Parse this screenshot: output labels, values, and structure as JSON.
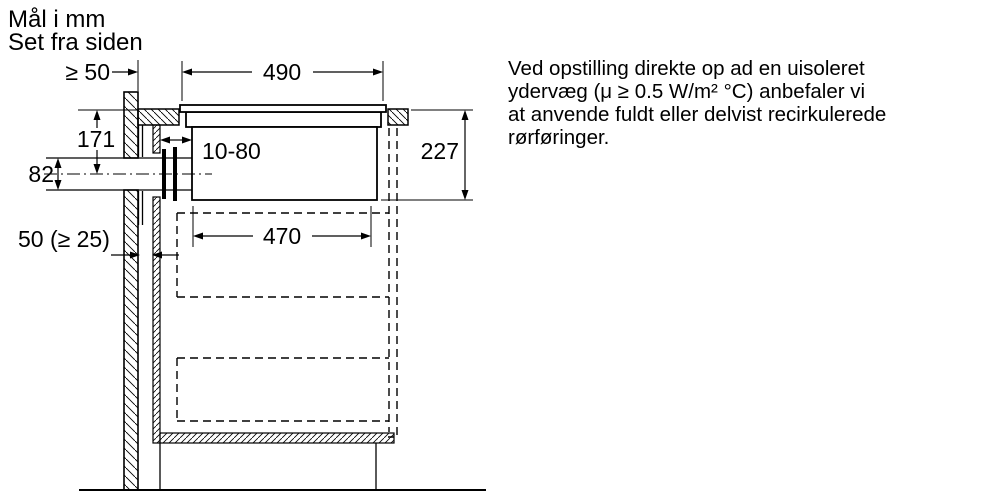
{
  "title": {
    "line1": "Mål i mm",
    "line2": "Set fra siden"
  },
  "dimensions": {
    "rear_clearance": "≥ 50",
    "cutout_width": "490",
    "worktop_to_duct_axis": "171",
    "duct_opening_height": "82",
    "wall_cabinet_gap_range": "10-80",
    "wall_to_cabinet": "50 (≥ 25)",
    "lower_housing_width": "470",
    "installation_depth": "227"
  },
  "note": {
    "line1": "Ved opstilling direkte op ad en uisoleret",
    "line2": "ydervæg (μ ≥ 0.5 W/m² °C) anbefaler vi",
    "line3": "at anvende fuldt eller delvist recirkulerede",
    "line4": "rørføringer."
  }
}
